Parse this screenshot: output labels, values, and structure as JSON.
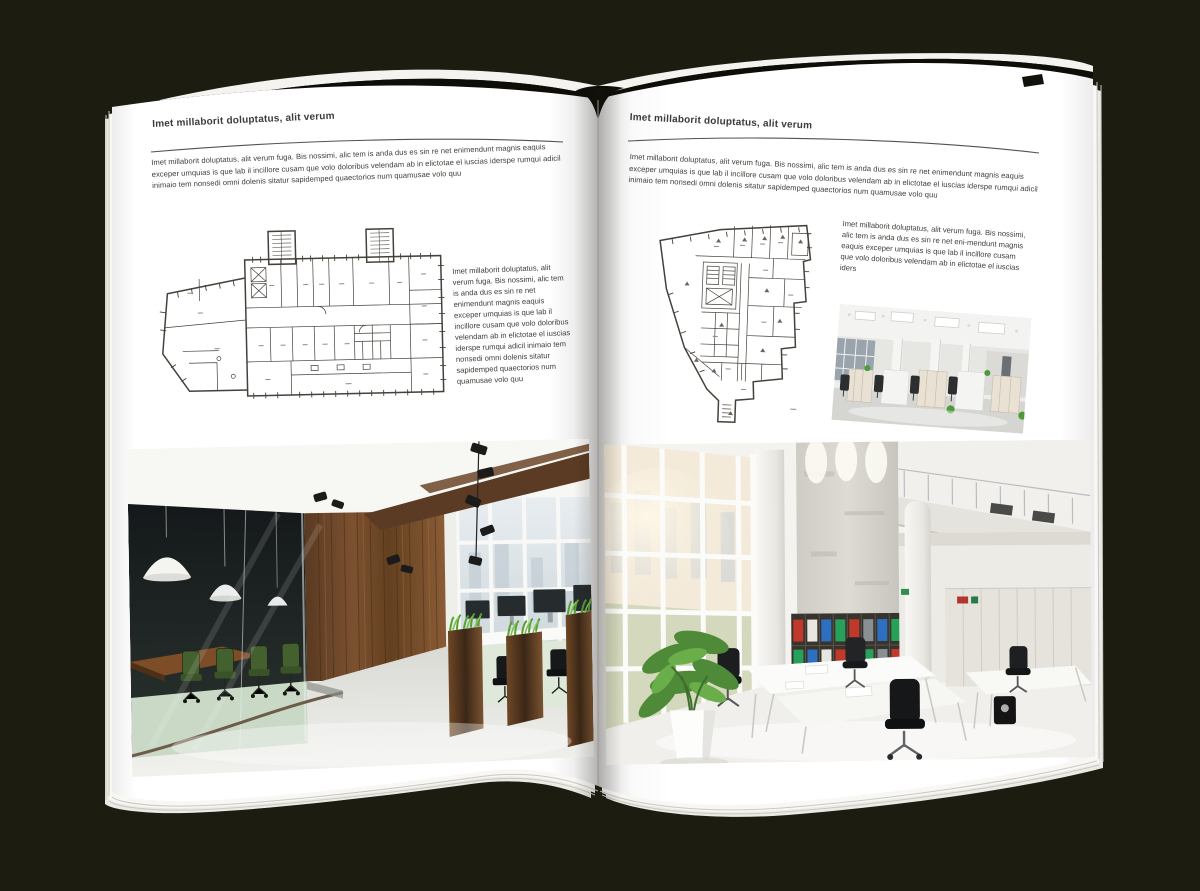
{
  "scene": {
    "background_color": "#1d1c11",
    "page_color": "#ffffff"
  },
  "left_page": {
    "header": "Imet millaborit doluptatus, alit verum",
    "intro": "Imet millaborit doluptatus, alit verum fuga. Bis nossimi, alic tem is anda dus es sin re net enimendunt magnis eaquis exceper umquias is que lab il incillore cusam que volo doloribus velendam ab in elictotae el iuscias iderspe rumqui adicil inimaio tem nonsedi omni dolenis sitatur sapidemped quaectorios num quamusae volo quu",
    "caption": "Imet millaborit doluptatus, alit verum fuga. Bis nossimi, alic tem is anda dus es sin re net enimendunt magnis eaquis exceper umquias is que lab il incillore cusam que volo doloribus velendam ab in elictotae el iuscias iderspe rumqui adicil inimaio tem nonsedi omni dolenis sitatur sapidemped quaectorios num quamusae volo quu"
  },
  "right_page": {
    "header": "Imet millaborit doluptatus, alit verum",
    "intro": "Imet millaborit doluptatus, alit verum fuga. Bis nossimi, alic tem is anda dus es sin re net enimendunt magnis eaquis exceper umquias is que lab il incillore cusam que volo doloribus velendam ab in elictotae el iuscias iderspe rumqui adicil inimaio tem nonsedi omni dolenis sitatur sapidemped quaectorios num quamusae volo quu",
    "caption": "Imet millaborit doluptatus, alit verum fuga. Bis nossimi, alic tem is anda dus es sin re net eni-mendunt magnis eaquis exceper umquias is que lab il incillore cusam que volo doloribus velendam ab in elictotae el iuscias iders"
  }
}
